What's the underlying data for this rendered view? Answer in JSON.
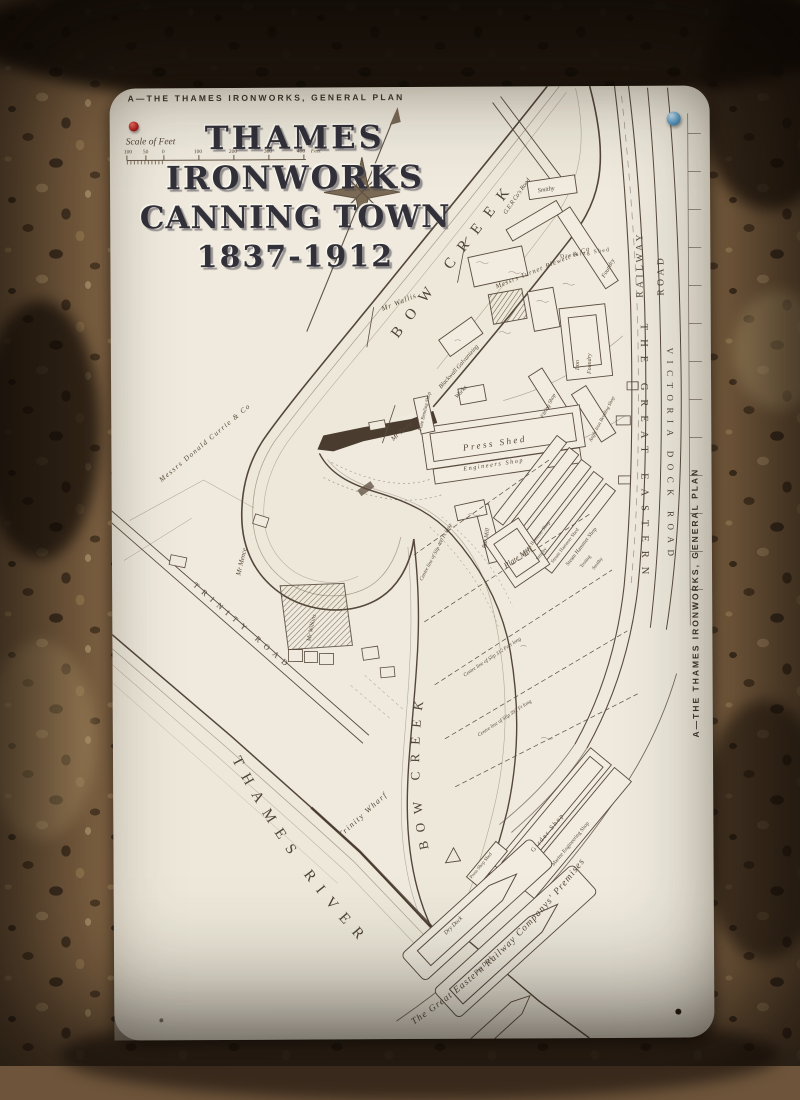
{
  "sign": {
    "top_caption": "A—THE THAMES IRONWORKS, GENERAL PLAN",
    "side_caption": "A—THE THAMES IRONWORKS, GENERAL PLAN",
    "title_lines": [
      "THAMES",
      "IRONWORKS",
      "CANNING TOWN",
      "1837-1912"
    ],
    "scale": {
      "label": "Scale of Feet",
      "ticks": [
        "100",
        "50",
        "0",
        "100",
        "200",
        "300",
        "400"
      ],
      "unit": "Feet"
    }
  },
  "map": {
    "water": {
      "creek_upper": "BOW CREEK",
      "creek_lower": "BOW CREEK",
      "thames": "THAMES RIVER"
    },
    "roads": {
      "railway_top": "RAILWAY",
      "road_top": "ROAD",
      "railway_main": "THE GREAT EASTERN",
      "road_main": "VICTORIA DOCK ROAD",
      "ger_road": "G.E.R Co's Road",
      "trinity_road": "TRINITY ROAD",
      "premises": "The Great Eastern Railway Companys' Premises"
    },
    "riparian": {
      "currie": "Messrs Donald Currie & Co",
      "wallis": "Mr Wallis",
      "turner": "Messrs Turner Blewett & Co",
      "young": "Mr Young",
      "blackwall_1": "Blackwall Galvanizing",
      "blackwall_2": "Works"
    },
    "owners": {
      "mence": "Mr Mence",
      "wilkins": "Mr Wilkins"
    },
    "wharf": "Trinity Wharf",
    "buildings": {
      "smithy_top": "Smithy",
      "foundry": "Foundry",
      "dressing_shed": "Dressing Shed",
      "iron_1": "Iron",
      "iron_2": "Foundry",
      "fitting_shop": "Fitting Shop",
      "angle_iron": "Angle Iron Bending Shop",
      "press_shed": "Press Shed",
      "plate_bending": "Plate Bending Shop",
      "engineers": "Engineers Shop",
      "sh_shop1": "Steam Hammer Shop",
      "smithy_mid": "Smithy",
      "sh_shed": "Steam Hammer Shed",
      "sh_shop2": "Steam Hammer Shop",
      "testing": "Testing",
      "smithy_low": "Smithy",
      "plate_mill": "Plate Mill",
      "bar_mill": "Bar Mill",
      "girder_shop": "Girder Shop",
      "marine_eng": "Marine Engineering Shop",
      "press_shop_shed": "Press Shop Shed",
      "dry_dock1": "Dry Dock",
      "dry_dock2": "Dry Dock"
    },
    "slips": {
      "s1": "Centre line of Slip 400 Ft long",
      "s2": "Centre line of Slip 312 Feet long",
      "s3": "Centre line of Slip 392 Ft long"
    }
  }
}
